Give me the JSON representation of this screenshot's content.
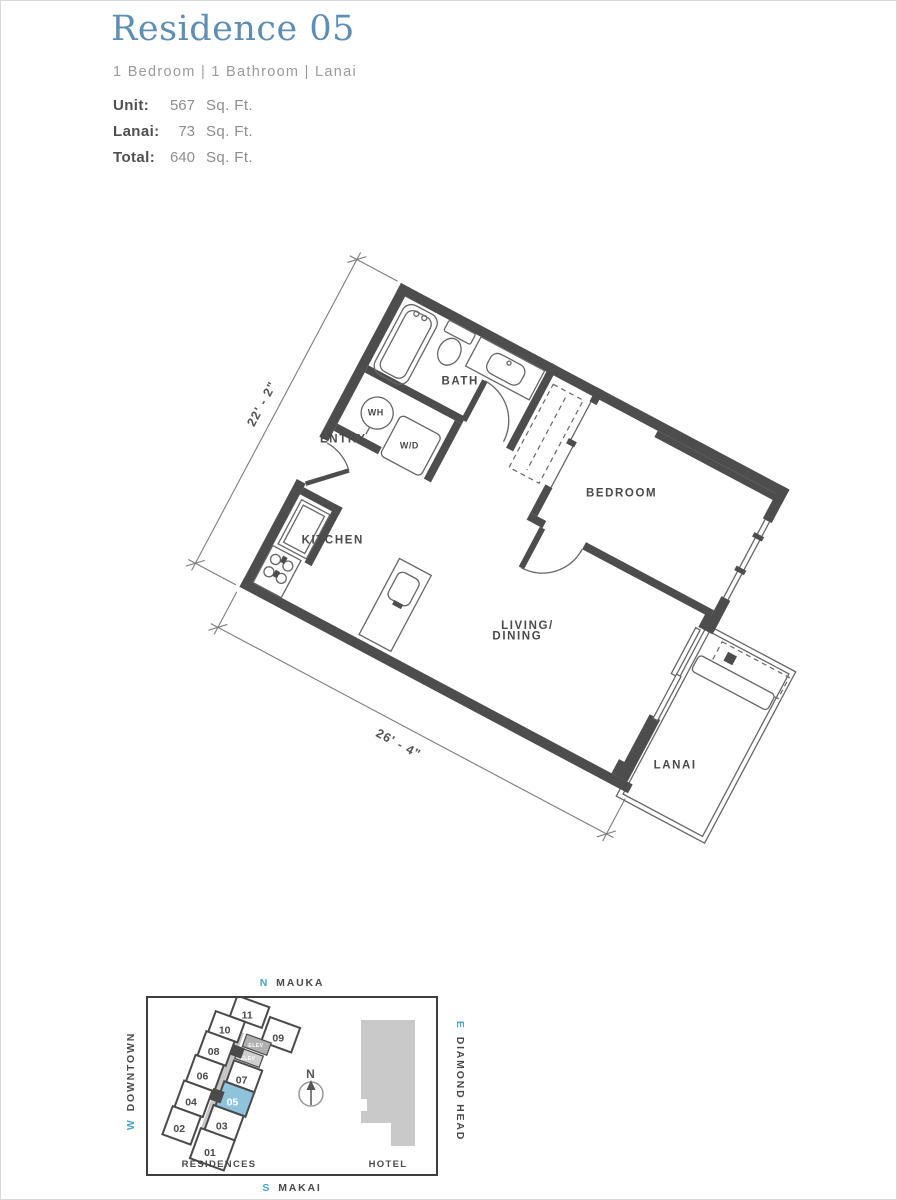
{
  "page": {
    "title": "Residence 05",
    "subtitle": "1 Bedroom | 1 Bathroom | Lanai",
    "stats": [
      {
        "label": "Unit:",
        "value": "567",
        "unit": "Sq. Ft."
      },
      {
        "label": "Lanai:",
        "value": "73",
        "unit": "Sq. Ft."
      },
      {
        "label": "Total:",
        "value": "640",
        "unit": "Sq. Ft."
      }
    ]
  },
  "floorplan": {
    "labels": {
      "bath": "BATH",
      "entry": "ENTRY",
      "kitchen": "KITCHEN",
      "bedroom": "BEDROOM",
      "living_line1": "LIVING/",
      "living_line2": "DINING",
      "lanai": "LANAI",
      "water_heater": "WH",
      "washer_dryer": "W/D"
    },
    "dimensions": {
      "left": "22' - 2\"",
      "bottom": "26' - 4\""
    }
  },
  "sitemap": {
    "compass_letter": "N",
    "directions": {
      "north": {
        "letter": "N",
        "name": "MAUKA"
      },
      "south": {
        "letter": "S",
        "name": "MAKAI"
      },
      "west": {
        "letter": "W",
        "name": "DOWNTOWN"
      },
      "east": {
        "letter": "E",
        "name": "DIAMOND HEAD"
      }
    },
    "buildings": {
      "residences": "RESIDENCES",
      "hotel": "HOTEL"
    },
    "elevator_label": "ELEV",
    "units": [
      {
        "number": "01",
        "highlighted": false
      },
      {
        "number": "02",
        "highlighted": false
      },
      {
        "number": "03",
        "highlighted": false
      },
      {
        "number": "04",
        "highlighted": false
      },
      {
        "number": "05",
        "highlighted": true
      },
      {
        "number": "06",
        "highlighted": false
      },
      {
        "number": "07",
        "highlighted": false
      },
      {
        "number": "08",
        "highlighted": false
      },
      {
        "number": "09",
        "highlighted": false
      },
      {
        "number": "10",
        "highlighted": false
      },
      {
        "number": "11",
        "highlighted": false
      }
    ]
  },
  "colors": {
    "title_blue": "#5e8fb3",
    "accent_teal": "#4aa3c5",
    "wall_gray": "#4d4d4d",
    "unit_highlight": "#8fc3dc",
    "hotel_gray": "#c9c9c9"
  }
}
